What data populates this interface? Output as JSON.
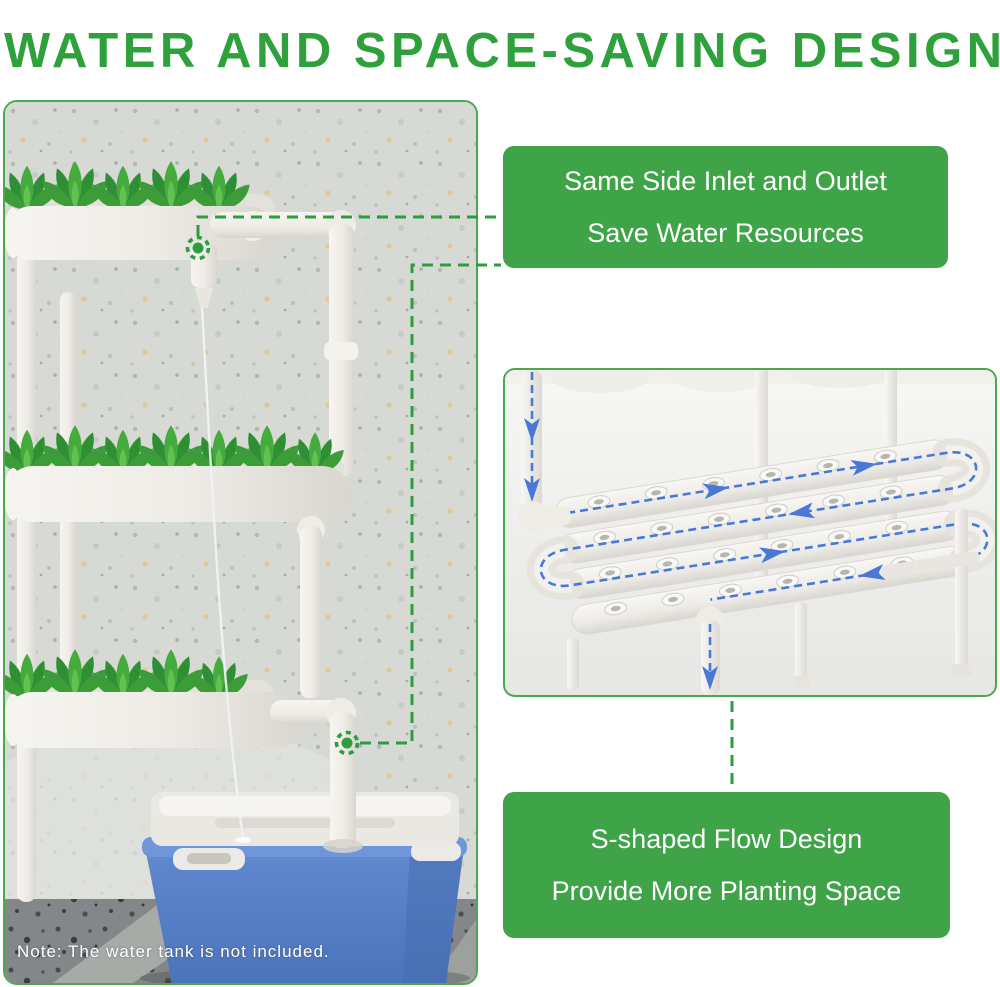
{
  "title": "WATER AND SPACE-SAVING DESIGN",
  "photo": {
    "note": "Note: The water tank is not included.",
    "description": "3-tier hydroponic pipe system with plants and blue water tank"
  },
  "callouts": {
    "same_side": {
      "line1": "Same Side Inlet and Outlet",
      "line2": "Save Water Resources"
    },
    "s_flow": {
      "line1": "S-shaped Flow Design",
      "line2": "Provide More Planting Space"
    }
  },
  "icons": {
    "outlet_marker": "target-marker-icon",
    "inlet_marker": "target-marker-icon",
    "flow_arrows": "arrow-down-icon / arrow-right-icon"
  },
  "colors": {
    "title_green": "#2fa13c",
    "callout_green": "#3fa347",
    "dashed_green": "#2d9e3f",
    "flow_blue": "#4a78d6",
    "tank_blue": "#5b84c9",
    "callout_text": "#ffffff"
  }
}
